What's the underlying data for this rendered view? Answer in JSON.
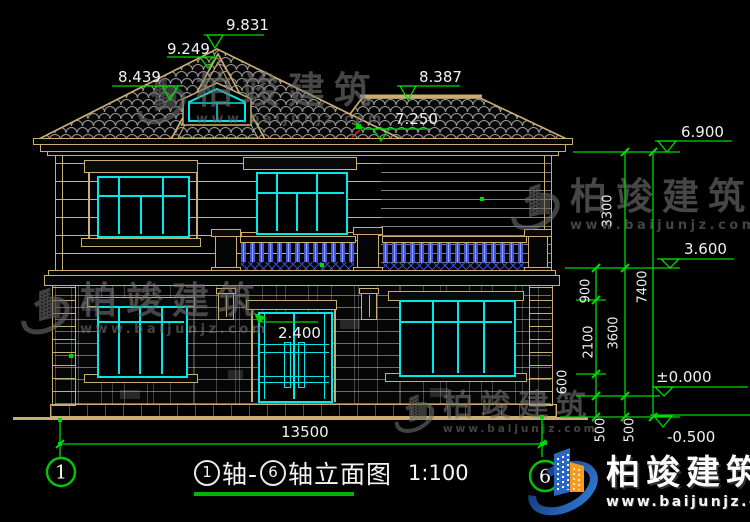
{
  "drawing": {
    "title": {
      "axis_start": "1",
      "axis_mid": "轴-",
      "axis_end": "6",
      "name": "轴立面图",
      "scale": "1:100"
    },
    "axis_markers": {
      "left": "1",
      "right": "6"
    },
    "levels": {
      "ridge": "9.831",
      "gable": "9.249",
      "roof_left": "8.439",
      "roof_right": "8.387",
      "roof_break": "7.250",
      "eave": "6.900",
      "second_floor": "3.600",
      "ground_floor": "±0.000",
      "site": "-0.500"
    },
    "dims": {
      "total_width": "13500",
      "door_height": "2.400",
      "eave_to_floor2": "3300",
      "floor2_to_zero": "3600",
      "total_height": "7400",
      "parapet": "900",
      "window_band": "2100",
      "sill_band": "600",
      "plinth_left": "500",
      "plinth_right": "500"
    },
    "colors": {
      "annotation_green": "#00d800",
      "line_tan": "#c9ad72",
      "glazing_cyan": "#00e8e8",
      "baluster_blue": "#4157d8",
      "logo_blue": "#2a66c4",
      "logo_orange": "#f59b1e"
    }
  },
  "watermark": {
    "brand": "柏竣建筑",
    "url": "www.baijunjz.com"
  },
  "logo": {
    "brand": "柏竣建筑",
    "url": "www.baijunjz.com"
  }
}
